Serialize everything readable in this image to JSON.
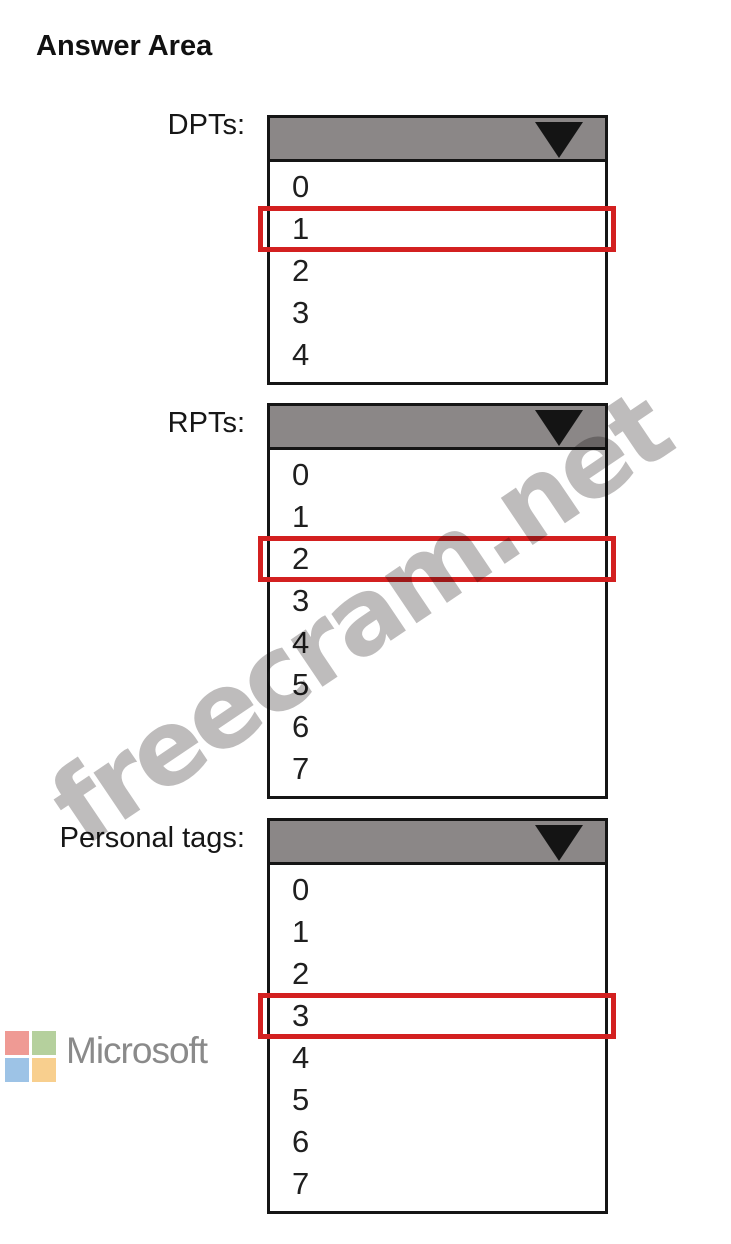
{
  "page": {
    "title": "Answer Area"
  },
  "colors": {
    "selection_red": "#d32020",
    "dropdown_header_gray": "#8b8787",
    "watermark_gray": "#969393",
    "ms_logo_text_gray": "#8a8a8a"
  },
  "dropdowns": [
    {
      "label": "DPTs:",
      "options": [
        "0",
        "1",
        "2",
        "3",
        "4"
      ],
      "selected_index": 1,
      "selected_value": "1"
    },
    {
      "label": "RPTs:",
      "options": [
        "0",
        "1",
        "2",
        "3",
        "4",
        "5",
        "6",
        "7"
      ],
      "selected_index": 2,
      "selected_value": "2"
    },
    {
      "label": "Personal tags:",
      "options": [
        "0",
        "1",
        "2",
        "3",
        "4",
        "5",
        "6",
        "7"
      ],
      "selected_index": 3,
      "selected_value": "3"
    }
  ],
  "watermark": {
    "text": "freecram.net"
  },
  "footer_logo": {
    "text": "Microsoft",
    "squares": [
      "#ef9a94",
      "#b5d09d",
      "#9dc3e6",
      "#f8cf8e"
    ]
  }
}
